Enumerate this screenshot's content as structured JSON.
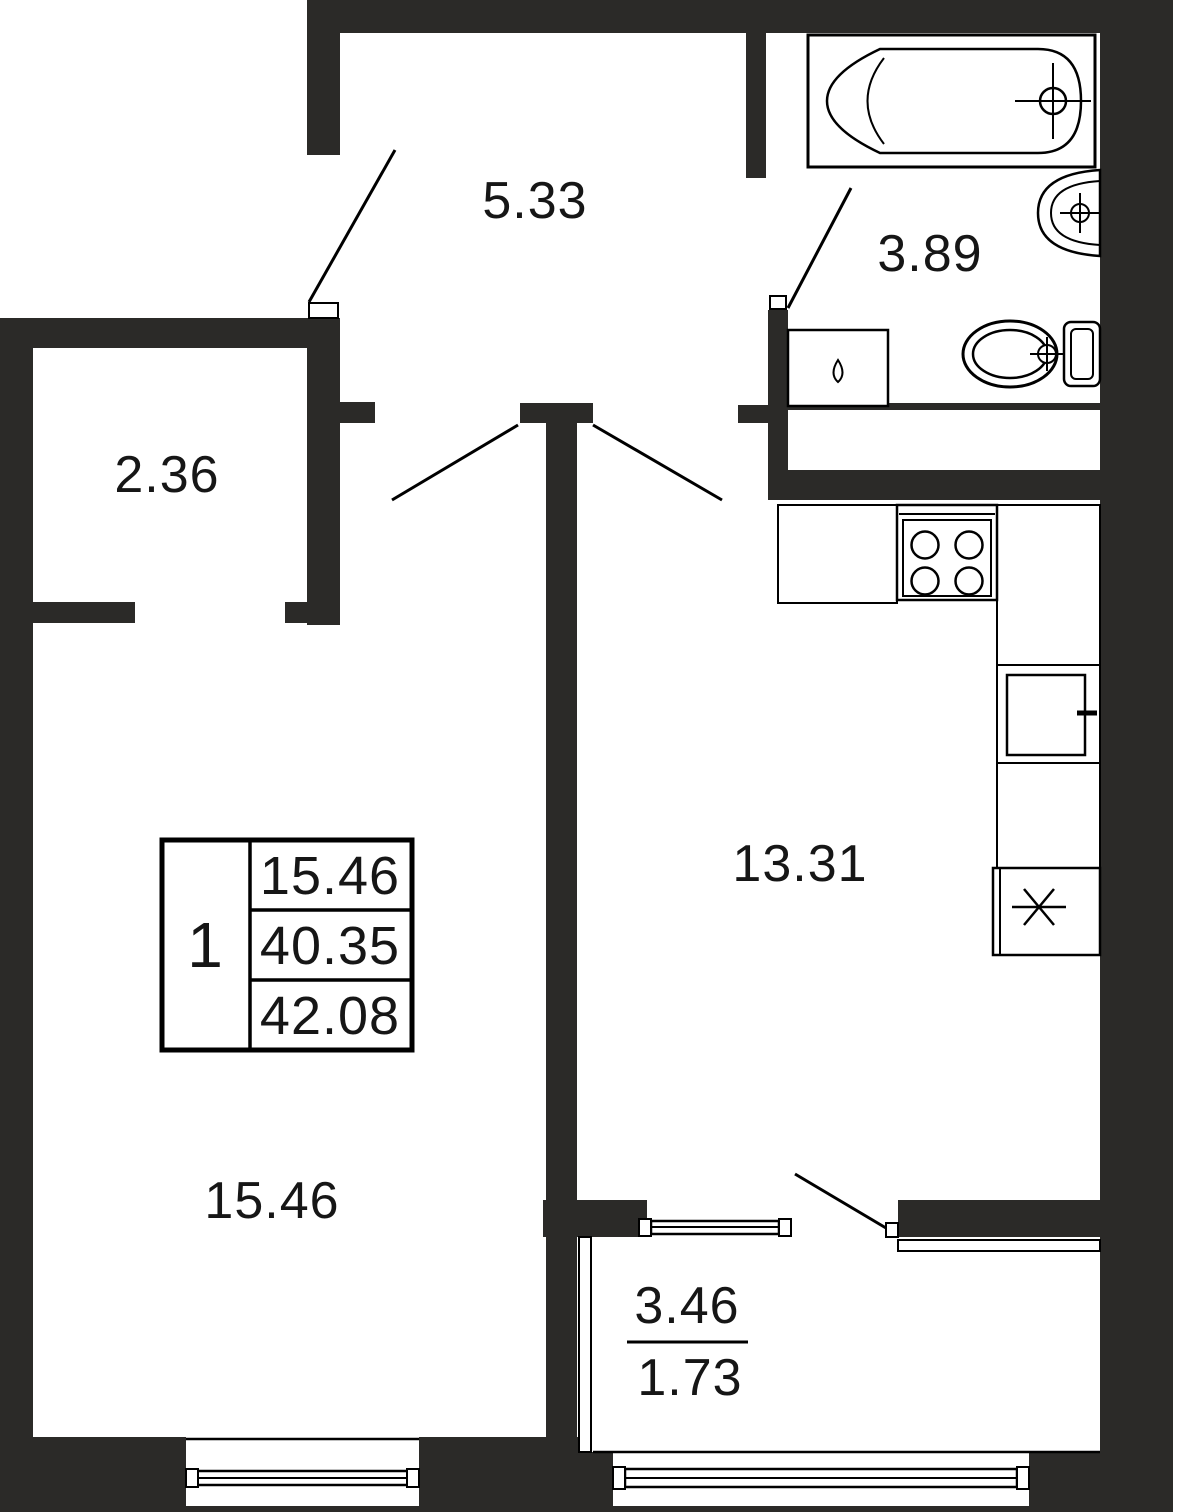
{
  "plan": {
    "type": "apartment-floor-plan",
    "colors": {
      "wall": "#2b2a28",
      "line": "#000000",
      "background": "#ffffff",
      "text": "#161616"
    },
    "rooms": {
      "hallway": {
        "area": "5.33"
      },
      "closet": {
        "area": "2.36"
      },
      "bathroom": {
        "area": "3.89"
      },
      "kitchen": {
        "area": "13.31"
      },
      "living_room": {
        "area": "15.46"
      },
      "balcony": {
        "area_total": "3.46",
        "area_counted": "1.73"
      }
    },
    "info_table": {
      "rooms_count": "1",
      "living_area": "15.46",
      "area_without_balcony": "40.35",
      "total_area": "42.08"
    },
    "fixtures": [
      "bathtub",
      "washbasin",
      "toilet",
      "washing-machine",
      "stove",
      "kitchen-counter",
      "kitchen-sink",
      "refrigerator"
    ]
  }
}
